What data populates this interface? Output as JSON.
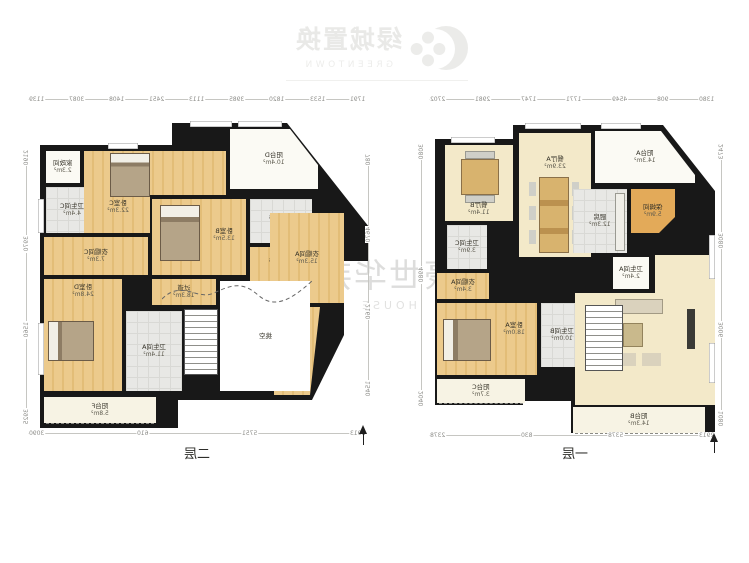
{
  "logo": {
    "brand_cn": "绿城置换",
    "brand_en": "GREENTOWN"
  },
  "watermark": {
    "text_cn": "豪世华邦",
    "text_en": "HOUSE"
  },
  "plans": [
    {
      "title": "二层",
      "rooms": [
        {
          "name": "家政间",
          "area": "2.3m²"
        },
        {
          "name": "卫生间C",
          "area": "4.4m²"
        },
        {
          "name": "衣帽间C",
          "area": "7.3m²"
        },
        {
          "name": "卧室C",
          "area": "22.3m²"
        },
        {
          "name": "阳台D",
          "area": "10.4m²"
        },
        {
          "name": "卧室B",
          "area": "13.5m²"
        },
        {
          "name": "卫生间B",
          "area": "4.4m²"
        },
        {
          "name": "衣帽间B",
          "area": "3.0m²"
        },
        {
          "name": "衣帽间A",
          "area": "15.3m²"
        },
        {
          "name": "过道",
          "area": "18.3m²"
        },
        {
          "name": "卫生间A",
          "area": "11.4m²"
        },
        {
          "name": "卧室D",
          "area": "24.8m²"
        },
        {
          "name": "阳台F",
          "area": "5.8m²"
        },
        {
          "name": "挑空",
          "area": ""
        }
      ],
      "dims": {
        "top": [
          "1139",
          "3087",
          "1408",
          "2451",
          "1113",
          "3985",
          "1820",
          "1533",
          "1791"
        ],
        "bottom": [
          "3090",
          "610",
          "5751",
          "2913"
        ],
        "left": [
          "2190",
          "3970",
          "1560",
          "3925"
        ],
        "right": [
          "780",
          "4670",
          "2160",
          "1540"
        ]
      }
    },
    {
      "title": "一层",
      "rooms": [
        {
          "name": "餐厅B",
          "area": "11.4m²"
        },
        {
          "name": "餐厅A",
          "area": "23.9m²"
        },
        {
          "name": "厨房",
          "area": "12.3m²"
        },
        {
          "name": "保姆间",
          "area": "5.9m²"
        },
        {
          "name": "阳台A",
          "area": "14.3m²"
        },
        {
          "name": "卫生间A",
          "area": "2.4m²"
        },
        {
          "name": "卫生间C",
          "area": "3.9m²"
        },
        {
          "name": "衣帽间A",
          "area": "3.4m²"
        },
        {
          "name": "卧室A",
          "area": "18.0m²"
        },
        {
          "name": "卫生间B",
          "area": "10.0m²"
        },
        {
          "name": "客厅",
          "area": "45.9m²"
        },
        {
          "name": "阳台C",
          "area": "3.7m²"
        },
        {
          "name": "阳台B",
          "area": "14.3m²"
        }
      ],
      "dims": {
        "top": [
          "2702",
          "2981",
          "1747",
          "1771",
          "4549",
          "908",
          "1380"
        ],
        "bottom": [
          "2378",
          "830",
          "5378",
          "2913"
        ],
        "left": [
          "3080",
          "4980",
          "2040"
        ],
        "right": [
          "2473",
          "3080",
          "3006",
          "1080"
        ]
      }
    }
  ]
}
